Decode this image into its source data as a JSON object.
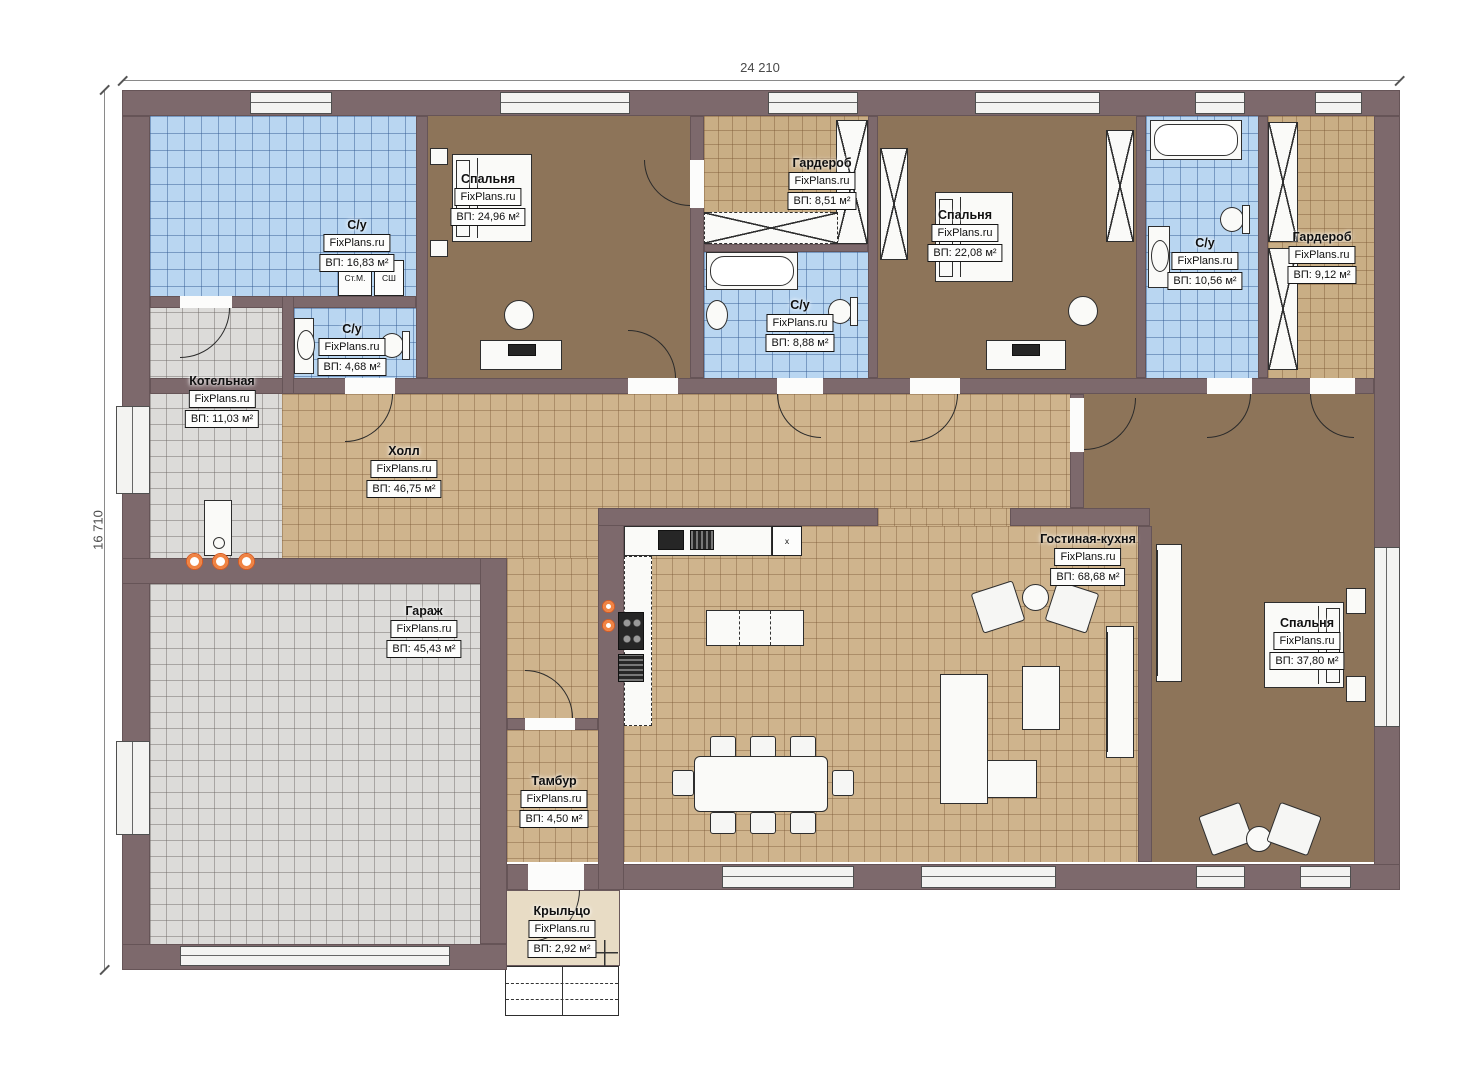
{
  "dimensions": {
    "width": "24 210",
    "height": "16 710"
  },
  "watermark": "FixPlans.ru",
  "appliances": {
    "washer": "Ст.М.",
    "dryer": "СШ",
    "x_unit": "x"
  },
  "rooms": [
    {
      "id": "bathroom-1",
      "name": "С/у",
      "area": "ВП: 16,83 м²"
    },
    {
      "id": "bedroom-1",
      "name": "Спальня",
      "area": "ВП: 24,96 м²"
    },
    {
      "id": "wardrobe-1",
      "name": "Гардероб",
      "area": "ВП: 8,51 м²"
    },
    {
      "id": "bathroom-2",
      "name": "С/у",
      "area": "ВП: 8,88 м²"
    },
    {
      "id": "bedroom-2",
      "name": "Спальня",
      "area": "ВП: 22,08 м²"
    },
    {
      "id": "bathroom-3",
      "name": "С/у",
      "area": "ВП: 10,56 м²"
    },
    {
      "id": "wardrobe-2",
      "name": "Гардероб",
      "area": "ВП: 9,12 м²"
    },
    {
      "id": "boiler-room",
      "name": "Котельная",
      "area": "ВП: 11,03 м²"
    },
    {
      "id": "bathroom-4",
      "name": "С/у",
      "area": "ВП: 4,68 м²"
    },
    {
      "id": "hall",
      "name": "Холл",
      "area": "ВП: 46,75 м²"
    },
    {
      "id": "garage",
      "name": "Гараж",
      "area": "ВП: 45,43 м²"
    },
    {
      "id": "vestibule",
      "name": "Тамбур",
      "area": "ВП: 4,50 м²"
    },
    {
      "id": "living-kitchen",
      "name": "Гостиная-кухня",
      "area": "ВП: 68,68 м²"
    },
    {
      "id": "bedroom-3",
      "name": "Спальня",
      "area": "ВП: 37,80 м²"
    },
    {
      "id": "porch",
      "name": "Крыльцо",
      "area": "ВП: 2,92 м²"
    }
  ],
  "colors": {
    "wall": "#7d696c",
    "tile_blue": "#b9d6f1",
    "tile_beige": "#cfb48d",
    "tile_gray": "#dcdbd9",
    "tile_tan": "#c9ae85",
    "floor_brown": "#8d7459",
    "porch": "#e8dcc5",
    "burner_orange": "#f08342"
  }
}
